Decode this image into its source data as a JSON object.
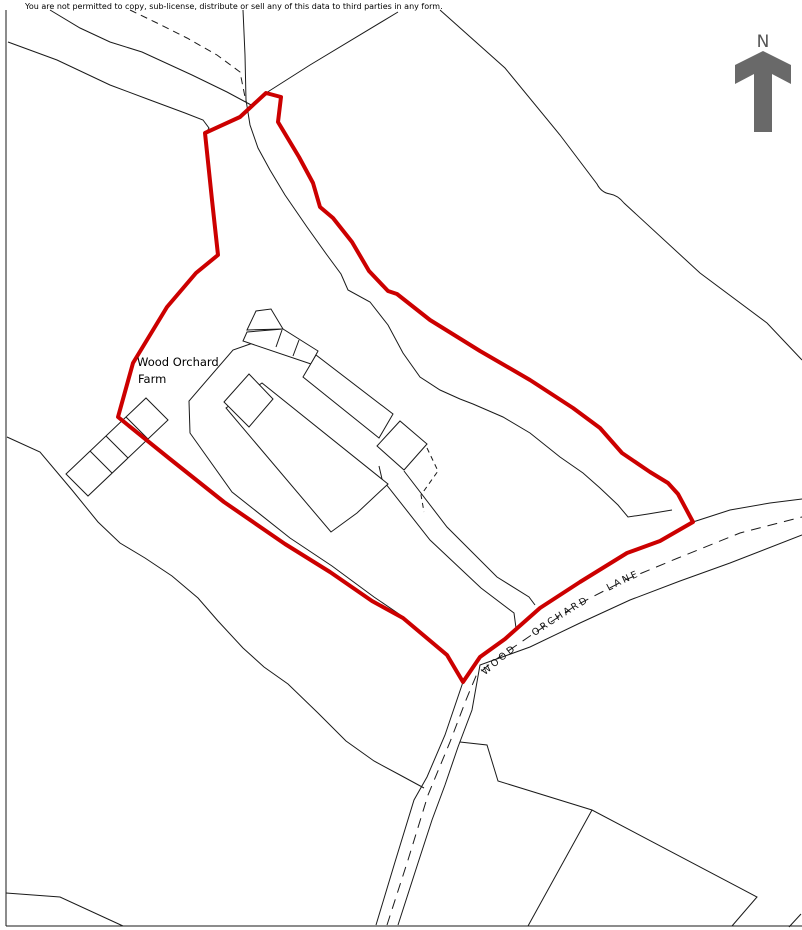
{
  "map": {
    "copyright": "You are not permitted to copy, sub-license, distribute or sell any of this data to third parties in any form.",
    "labels": {
      "farm_line1": "Wood Orchard",
      "farm_line2": "Farm",
      "road_name": "WOOD ORCHARD LANE",
      "north": "N"
    },
    "colors": {
      "boundary_red": "#cc0000",
      "line_black": "#1a1a1a",
      "north_arrow_gray": "#696969",
      "background": "#ffffff"
    }
  }
}
